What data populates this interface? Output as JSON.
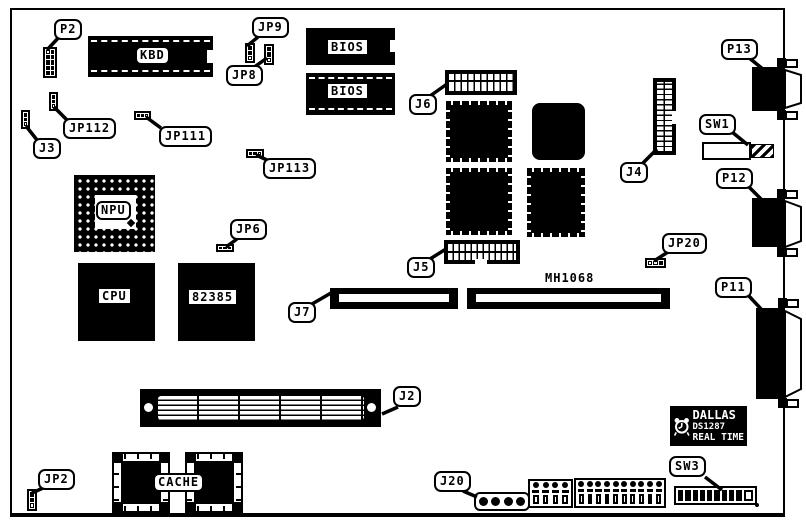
{
  "labels": {
    "p2": "P2",
    "kbd": "KBD",
    "jp9": "JP9",
    "jp8": "JP8",
    "bios1": "BIOS",
    "bios2": "BIOS",
    "j6": "J6",
    "j4": "J4",
    "p13": "P13",
    "sw1": "SW1",
    "p12": "P12",
    "jp112": "JP112",
    "jp111": "JP111",
    "j3": "J3",
    "jp113": "JP113",
    "npu": "NPU",
    "jp6": "JP6",
    "cpu": "CPU",
    "chip82385": "82385",
    "j5": "J5",
    "j7": "J7",
    "mh1068": "MH1068",
    "jp20": "JP20",
    "p11": "P11",
    "j2": "J2",
    "jp2": "JP2",
    "cache": "CACHE",
    "j20": "J20",
    "sw3": "SW3"
  },
  "rtc": {
    "brand": "DALLAS",
    "part": "DS1287",
    "type": "REAL TIME"
  },
  "colors": {
    "ink": "#000000",
    "board": "#ffffff"
  }
}
